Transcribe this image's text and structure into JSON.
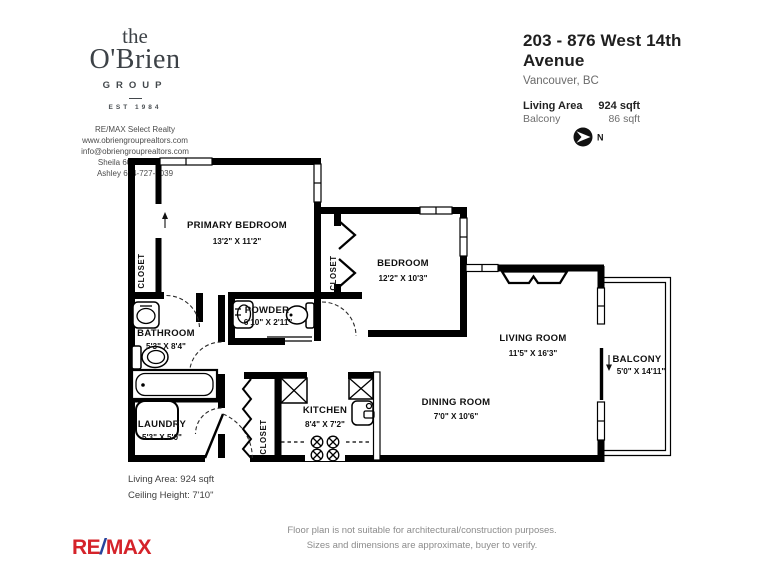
{
  "header": {
    "logo": {
      "line1": "the",
      "line2": "O'Brien",
      "line3": "GROUP",
      "est": "EST 1984"
    },
    "contact": [
      "RE/MAX Select Realty",
      "www.obriengrouprealtors.com",
      "info@obriengrouprealtors.com",
      "Sheila 604-828-1006",
      "Ashley 604-727-9039"
    ],
    "address": "203 - 876 West 14th Avenue",
    "city": "Vancouver, BC",
    "living_area_label": "Living Area",
    "living_area_value": "924 sqft",
    "balcony_label": "Balcony",
    "balcony_value": "86 sqft"
  },
  "compass": {
    "north": "N"
  },
  "rooms": {
    "primary_bedroom": {
      "name": "PRIMARY BEDROOM",
      "dims": "13'2\" X 11'2\""
    },
    "bedroom": {
      "name": "BEDROOM",
      "dims": "12'2\" X 10'3\""
    },
    "living_room": {
      "name": "LIVING ROOM",
      "dims": "11'5\" X 16'3\""
    },
    "dining_room": {
      "name": "DINING ROOM",
      "dims": "7'0\" X 10'6\""
    },
    "kitchen": {
      "name": "KITCHEN",
      "dims": "8'4\" X 7'2\""
    },
    "bathroom": {
      "name": "BATHROOM",
      "dims": "5'3\" X 8'4\""
    },
    "powder": {
      "name": "POWDER",
      "dims": "6'10\" X 2'11\""
    },
    "laundry": {
      "name": "LAUNDRY",
      "dims": "5'3\" X 5'0\""
    },
    "balcony": {
      "name": "BALCONY",
      "dims": "5'0\" X 14'11\""
    },
    "closet_label": "CLOSET"
  },
  "footer": {
    "living_area": "Living Area: 924 sqft",
    "ceiling": "Ceiling Height: 7'10\"",
    "remax": {
      "re": "RE",
      "slash": "/",
      "max": "MAX"
    },
    "disclaimer1": "Floor plan is not suitable for architectural/construction purposes.",
    "disclaimer2": "Sizes and dimensions are approximate, buyer to verify."
  },
  "colors": {
    "wall": "#000000",
    "remax_red": "#d5232a",
    "remax_blue": "#27449c"
  }
}
